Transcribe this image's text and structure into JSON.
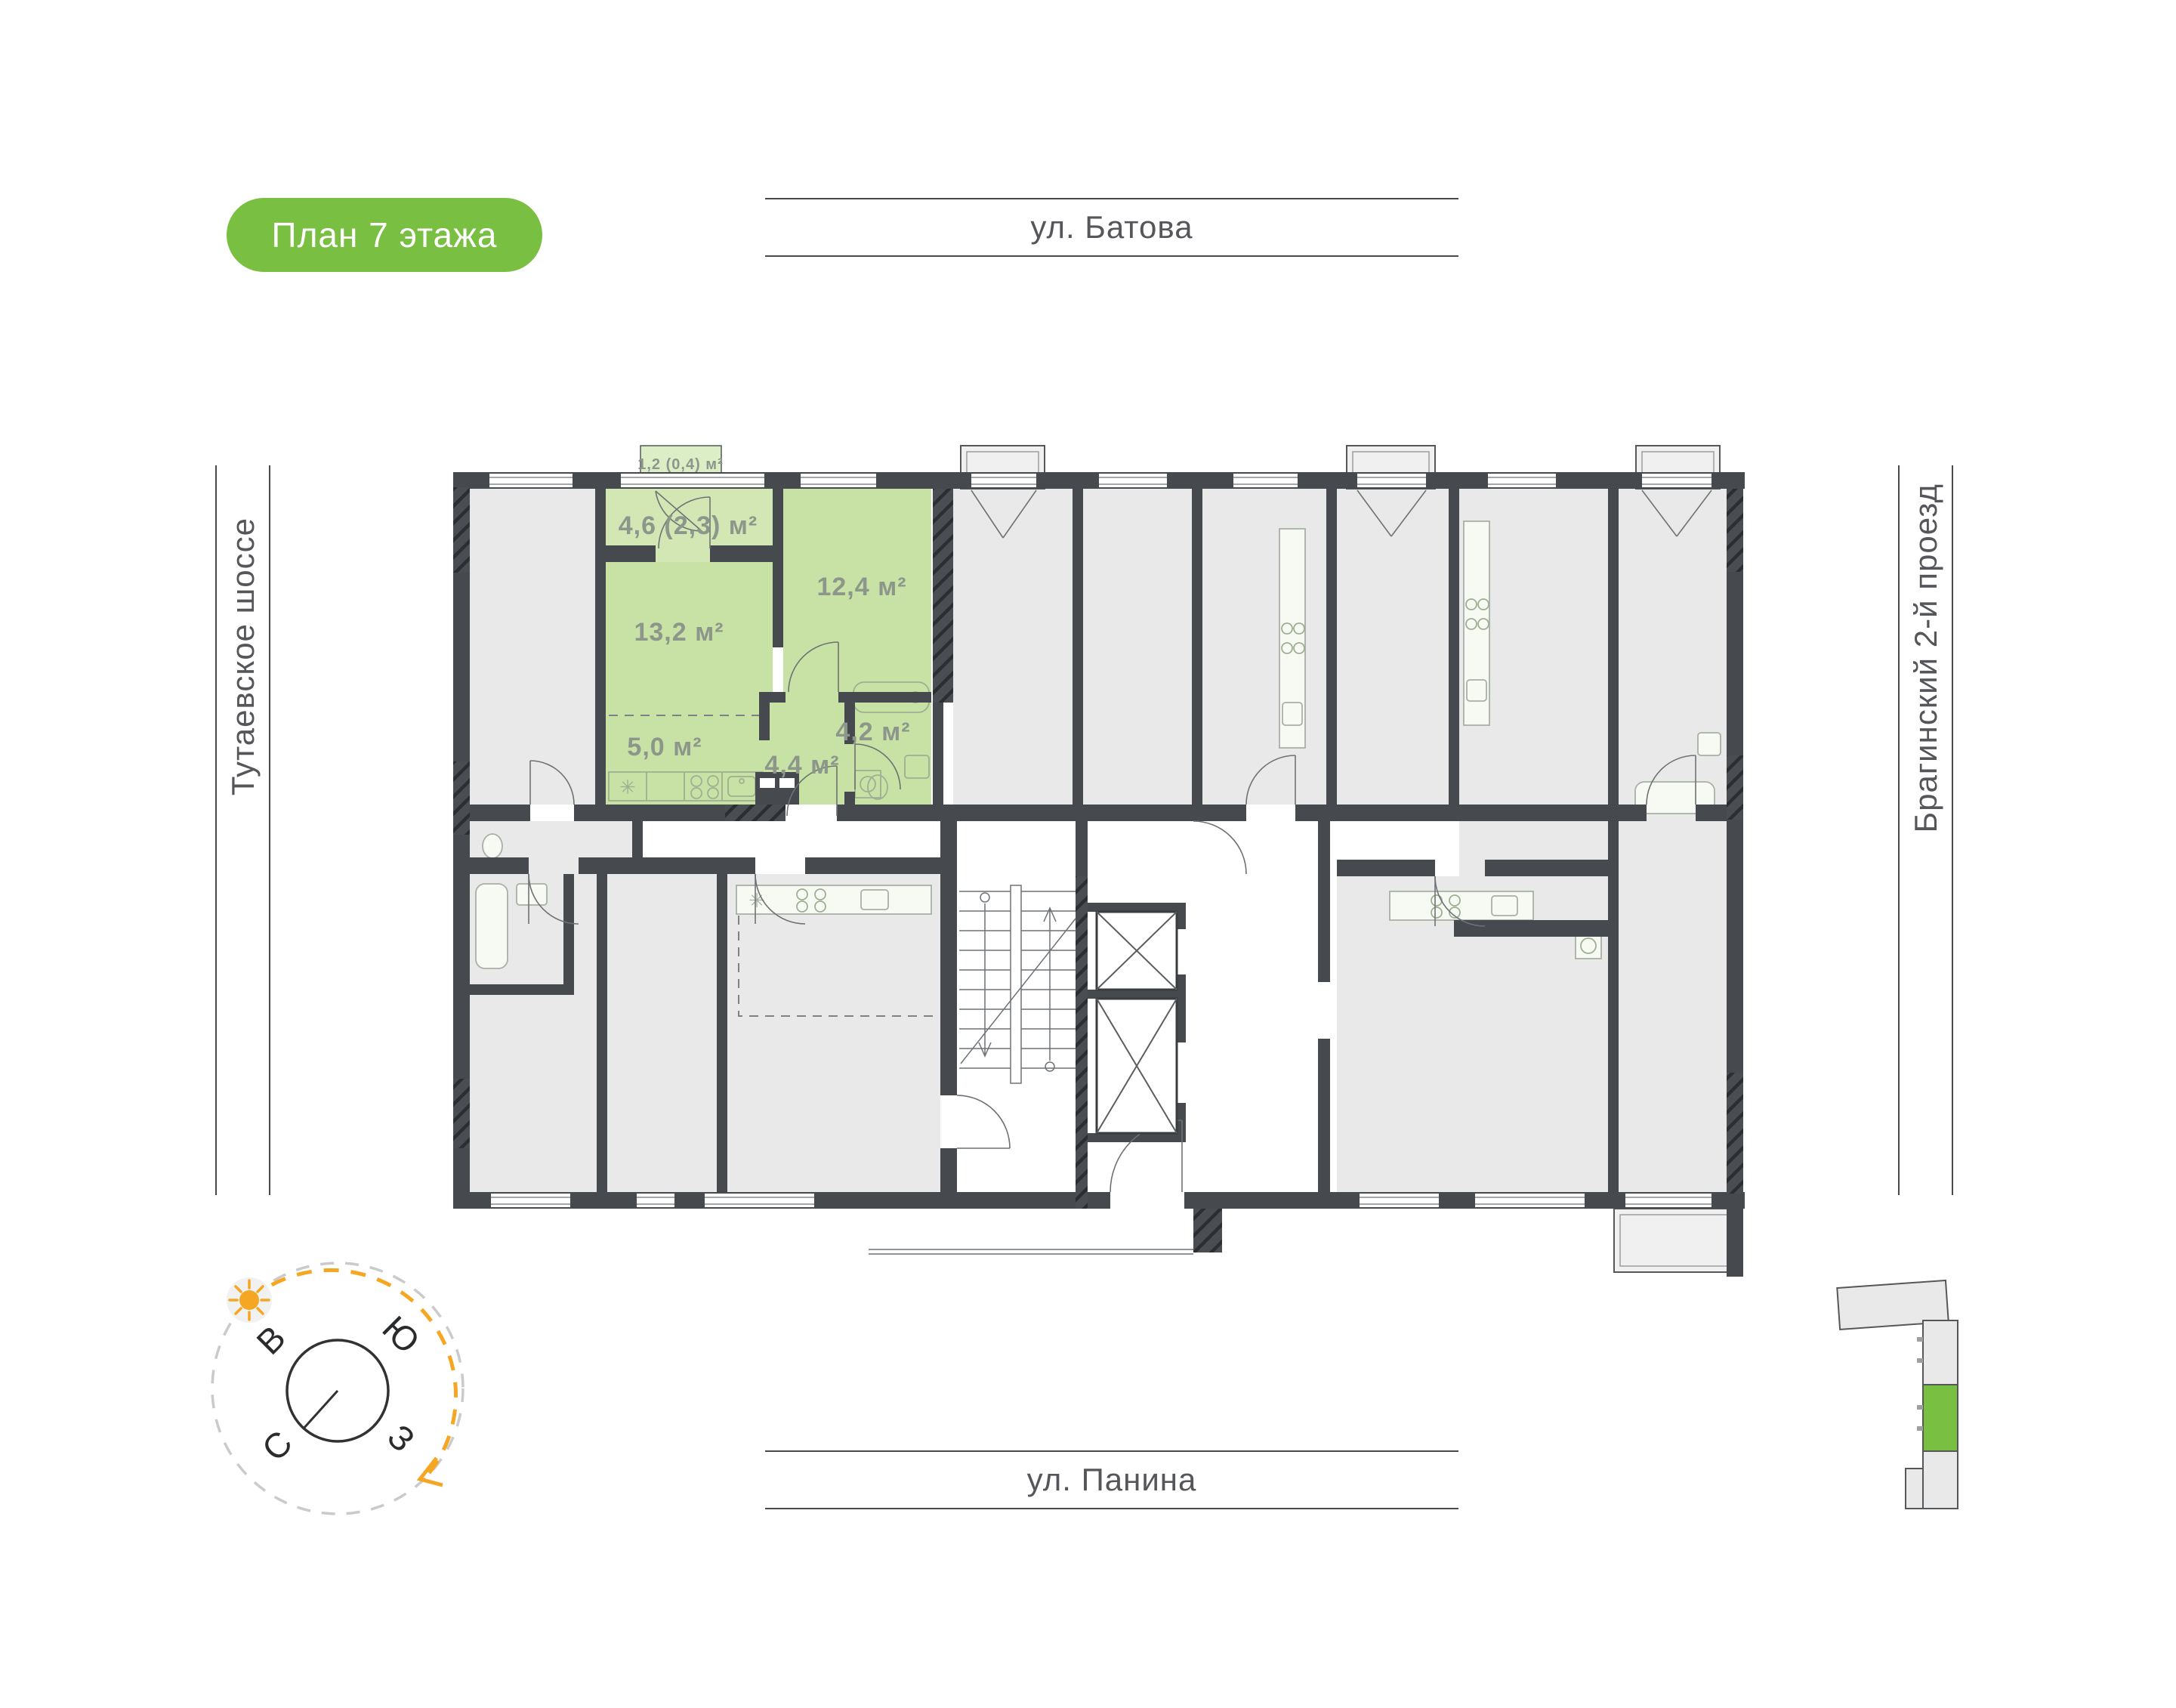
{
  "title_badge": {
    "label": "План 7 этажа"
  },
  "streets": {
    "top": {
      "name": "ул. Батова"
    },
    "bottom": {
      "name": "ул. Панина"
    },
    "left": {
      "name": "Тутаевское шоссе"
    },
    "right": {
      "name": "Брагинский 2-й проезд"
    }
  },
  "floor_plan": {
    "selected_apartment": {
      "rooms": {
        "balcony": "1,2 (0,4) м²",
        "loggia": "4,6 (2,3) м²",
        "bedroom": "12,4 м²",
        "living_room": "13,2 м²",
        "kitchen": "5,0 м²",
        "hallway": "4,4 м²",
        "bathroom": "4,2 м²"
      }
    }
  },
  "compass": {
    "labels": {
      "east": "В",
      "south": "Ю",
      "north": "С",
      "west": "З"
    }
  },
  "colors": {
    "badge_green": "#79BF41",
    "apartment_green": "#C8E1A5",
    "loggia_green": "#D2E7B4",
    "balcony_green": "#DCEEC6",
    "area_label": "#8C968B",
    "wall_dark": "#46494D",
    "apartment_gray": "#E9E9EA",
    "balcony_gray": "#F0F0F1",
    "street_text": "#55565A",
    "compass_accent": "#F5A623",
    "minimap_green": "#79BF41"
  }
}
